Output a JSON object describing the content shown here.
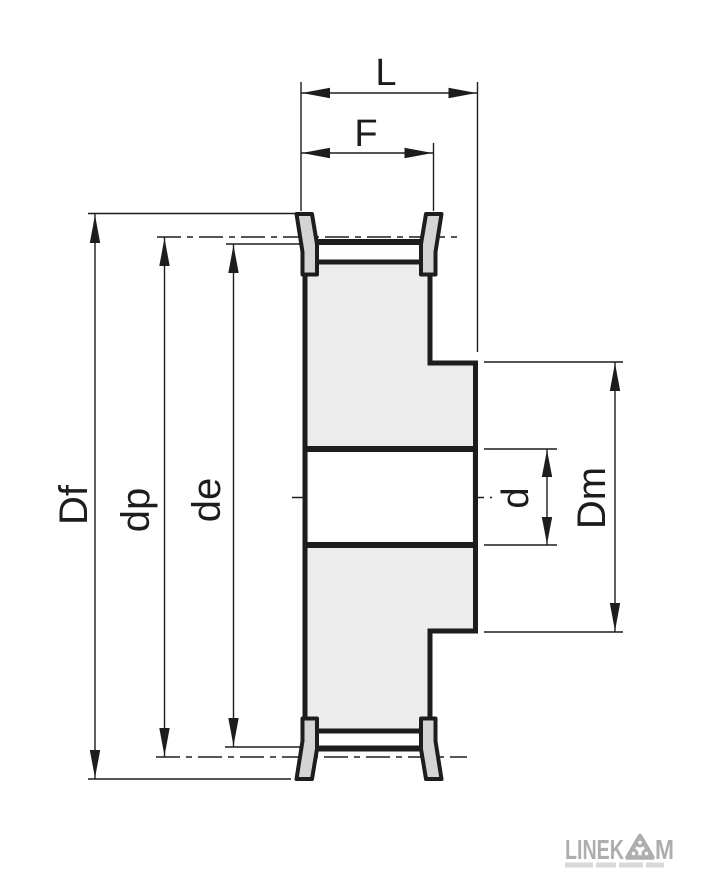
{
  "dimension_labels": {
    "L": "L",
    "F": "F",
    "Df": "Df",
    "dp": "dp",
    "de": "de",
    "d": "d",
    "Dm": "Dm"
  },
  "logo": {
    "brand_prefix": "LINEK",
    "brand_suffix": "M",
    "emblem_icon": "three-pulley-triangle-icon"
  },
  "colors": {
    "line": "#1d1d1b",
    "body_fill": "#ebeceb",
    "flange_fill": "#d3d5d4",
    "bore_fill": "#ffffff",
    "logo_gray": "#aeaeae",
    "tagline_gray": "#d9d9d9",
    "background": "#ffffff"
  }
}
